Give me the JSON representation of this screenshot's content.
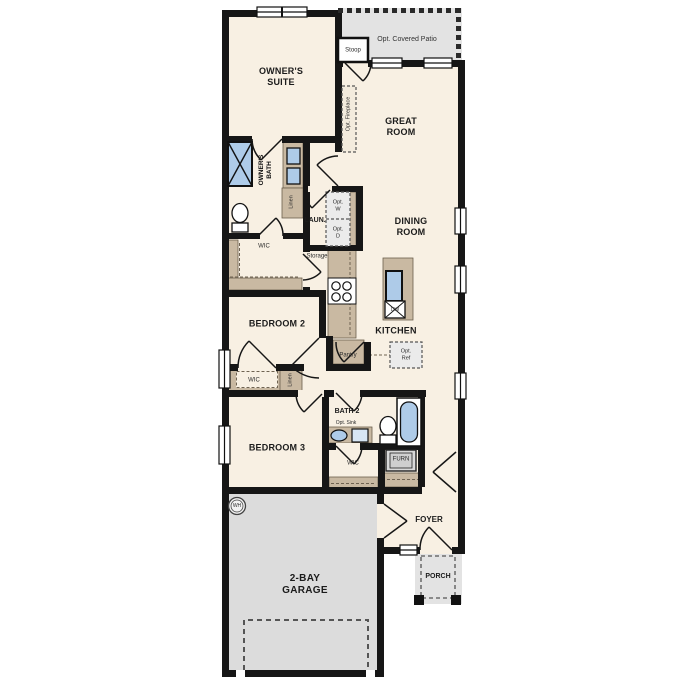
{
  "labels": {
    "owners_suite": "OWNER'S\nSUITE",
    "stoop": "Stoop",
    "opt_covered_patio": "Opt. Covered Patio",
    "great_room": "GREAT\nROOM",
    "opt_fireplace": "Opt. Fireplace",
    "owners_bath": "OWNER'S\nBATH",
    "linen1": "Linen",
    "wic1": "WIC",
    "laundry": "LAUN.",
    "opt_w": "Opt.\nW",
    "opt_d": "Opt.\nD",
    "storage": "Storage",
    "dining_room": "DINING\nROOM",
    "kitchen": "KITCHEN",
    "dw": "DW",
    "bedroom2": "BEDROOM 2",
    "wic2": "WIC",
    "linen2": "Linen",
    "pantry": "Pantry",
    "opt_ref": "Opt.\nRef",
    "bath2": "BATH 2",
    "opt_sink": "Opt. Sink",
    "bedroom3": "BEDROOM 3",
    "wic3": "WIC",
    "furn": "FURN",
    "wh": "WH",
    "foyer": "FOYER",
    "garage": "2-BAY\nGARAGE",
    "porch": "PORCH"
  },
  "colors": {
    "floor": "#f8f0e3",
    "wall": "#161616",
    "cabinet": "#c9b9a2",
    "exterior_concrete": "#e2e2e2",
    "fixture_blue": "#aecbe8",
    "optional_dash": "#555555"
  }
}
